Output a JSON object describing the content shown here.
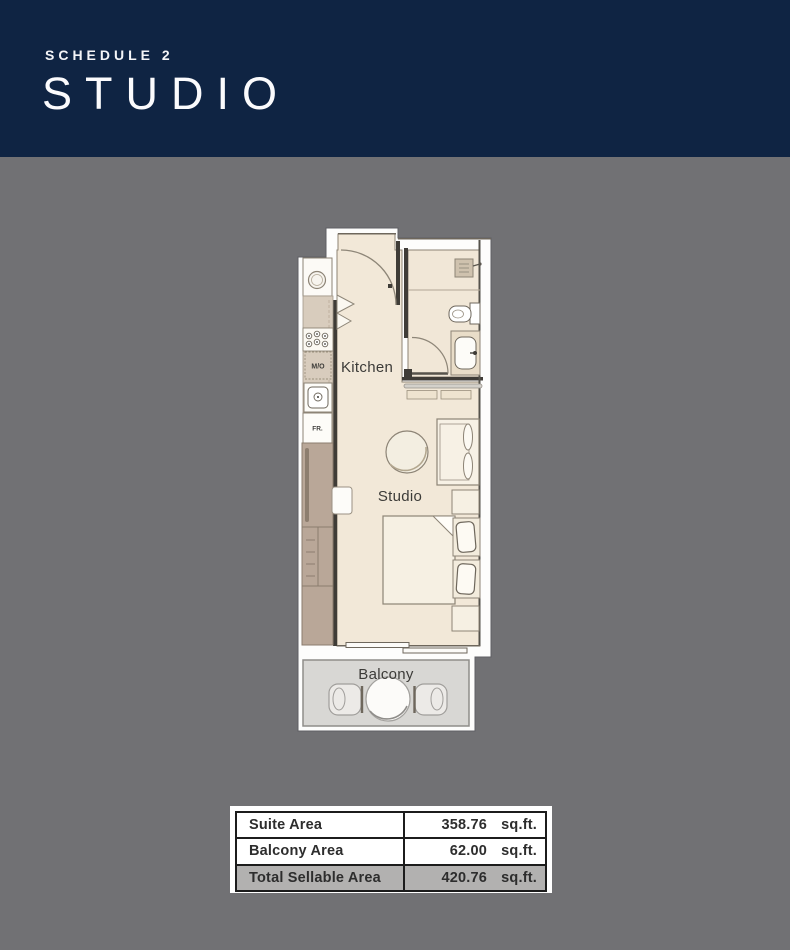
{
  "header": {
    "schedule_label": "SCHEDULE 2",
    "title": "STUDIO",
    "bg_color": "#0f2443",
    "text_color": "#ffffff"
  },
  "floorplan": {
    "labels": {
      "kitchen": "Kitchen",
      "studio": "Studio",
      "balcony": "Balcony",
      "microwave": "M/O",
      "fridge": "FR."
    },
    "colors": {
      "page_background": "#717174",
      "plan_white": "#fdfdfc",
      "floor_cream": "#f2e8d8",
      "wall_dark": "#3f3c37",
      "wardrobe_brown": "#b9a798",
      "counter_beige": "#d8ccbd",
      "balcony_floor": "#d8d7d4"
    }
  },
  "area_table": {
    "rows": [
      {
        "label": "Suite Area",
        "value": "358.76",
        "unit": "sq.ft."
      },
      {
        "label": "Balcony Area",
        "value": "62.00",
        "unit": "sq.ft."
      },
      {
        "label": "Total Sellable Area",
        "value": "420.76",
        "unit": "sq.ft."
      }
    ],
    "highlight_color": "#b2b1b0"
  }
}
